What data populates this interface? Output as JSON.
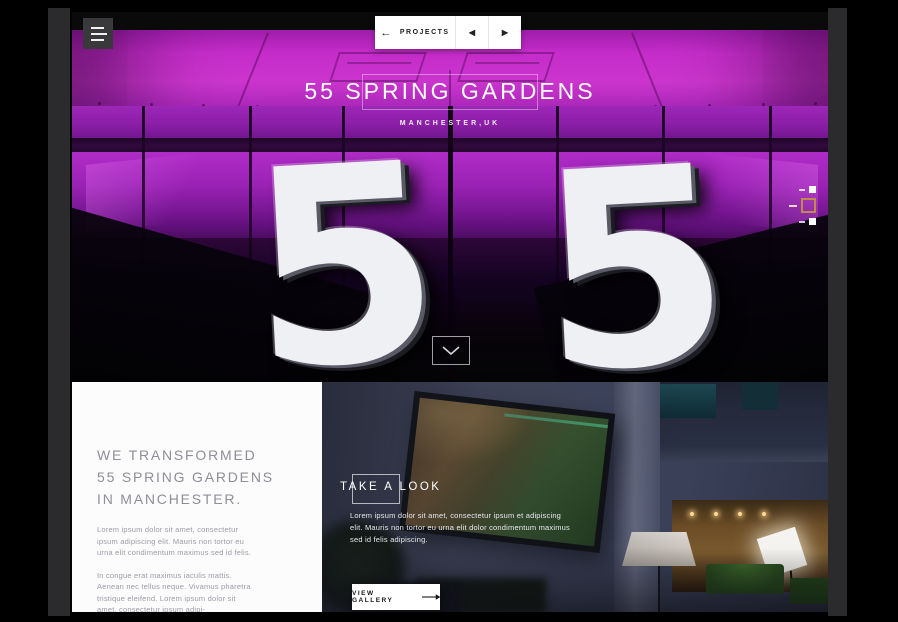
{
  "nav": {
    "projects_label": "PROJECTS",
    "back_arrow": "←",
    "prev_arrow": "◀",
    "next_arrow": "▶"
  },
  "hero": {
    "title": "55 SPRING GARDENS",
    "location": "MANCHESTER,UK",
    "digits": [
      "5",
      "5"
    ],
    "pagination": {
      "total": 3,
      "active_index": 1
    }
  },
  "intro": {
    "heading_lines": [
      "WE TRANSFORMED",
      "55 SPRING GARDENS",
      "IN MANCHESTER."
    ],
    "paragraphs": [
      "Lorem ipsum dolor sit amet, consectetur ipsum adipiscing elit. Mauris non tortor eu urna elit condimentum maximus sed id felis.",
      "In congue erat maximus iaculis mattis. Aenean nec tellus neque. Vivamus pharetra tristique eleifend. Lorem ipsum dolor sit amet, consectetur ipsum adipi-"
    ]
  },
  "gallery": {
    "heading": "TAKE A LOOK",
    "paragraph": "Lorem ipsum dolor sit amet, consectetur ipsum et adipiscing elit. Mauris non tortor eu urna elit dolor condimentum maximus sed id felis adipiscing.",
    "button_label": "VIEW GALLERY"
  },
  "icons": {
    "menu": "hamburger-icon",
    "back": "arrow-left-icon",
    "prev": "caret-left-icon",
    "next": "caret-right-icon",
    "scroll": "chevron-down-icon",
    "gallery_arrow": "arrow-right-icon"
  },
  "colors": {
    "magenta": "#c72ecb",
    "deep_purple": "#5c0f75",
    "gold_accent": "#bf8a4c",
    "white": "#ffffff",
    "heading_gray": "#8e8e98",
    "body_gray": "#9b9ba4"
  }
}
